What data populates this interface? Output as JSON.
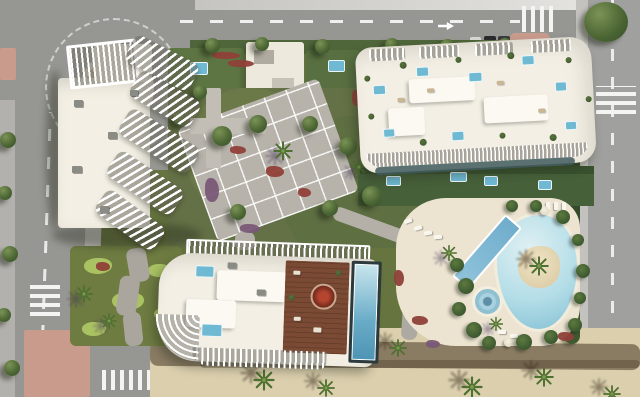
{
  "meta": {
    "title": "Aerial masterplan render of beachfront residential resort",
    "image_type": "architectural-3d-render",
    "visible_text": "none"
  },
  "palette": {
    "road": "#969692",
    "road_light": "#b3b1ad",
    "grass": "#66743f",
    "lawn": "#5d7443",
    "hedge": "#3c5830",
    "putting_green": "#a9c262",
    "roof": "#f3efe4",
    "roof_bright": "#fbf9f2",
    "deck": "#ece4d1",
    "pool_water": "#6fb9d2",
    "lagoon": "#b3dde7",
    "wood_deck": "#7a4a34",
    "red_bed": "#8f4038",
    "purple_bed": "#7a5878",
    "pink_paving": "#c99b8d",
    "plaza": "#b7b3ab",
    "sand": "#dbcfae",
    "glass": "#3f5b5d"
  },
  "labels": {
    "scene": "Aerial render of a beachfront residential resort masterplan",
    "top_road": "East-west road along the top with dashed lane markings",
    "left_road": "North-south road on the west side",
    "right_road": "North-south road on the east side",
    "roundabout": "Roundabout with rock-garden island",
    "crosswalk": "Pedestrian zebra crossing",
    "building_a": "West apartment tower with fanned louvered balcony terraces",
    "building_b": "North apartment block with rooftop terraces and plunge pools",
    "building_c": "South apartment block with rooftop wood deck and lap pool",
    "top_center_building": "Low annex building with roof terraces",
    "gardens": "Landscaped communal gardens with trees and flower beds",
    "plaza": "Central grid-paved pedestrian plaza",
    "mini_golf": "Mini-golf putting greens with winding path",
    "lagoon_pool": "Free-form lagoon pool with sandy palm island",
    "lap_pool": "Diagonal lap pool",
    "spa_pool": "Circular spa pool",
    "pool_deck": "Cream pool deck with sun loungers and parasols",
    "promenade": "Sandy beach promenade with palm trees and shadow band",
    "palm": "Palm tree",
    "tree": "Tree",
    "hedge": "Perimeter hedge",
    "parked_cars": "Parked cars on the top road",
    "island_sidewalk": "Pink paved sidewalk island"
  }
}
